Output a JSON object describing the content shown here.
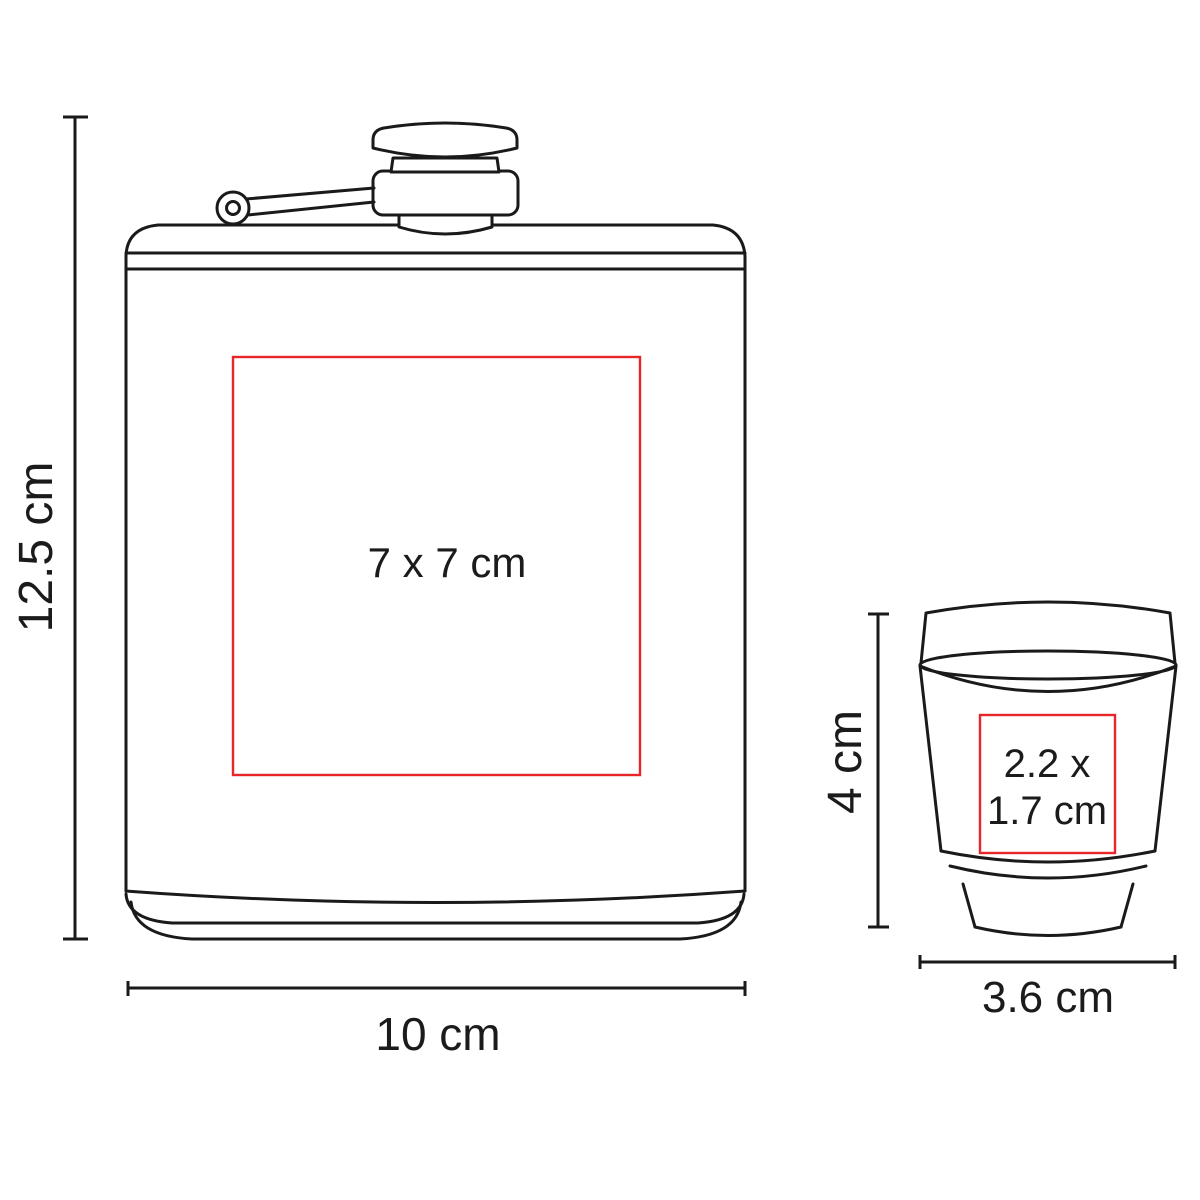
{
  "diagram": {
    "type": "product-dimension-diagram",
    "background": "#ffffff",
    "colors": {
      "line": "#1a1a1a",
      "print_area_red": "#e8262a",
      "text": "#1c1a1b"
    },
    "flask": {
      "name": "hip-flask",
      "height_label": "12.5 cm",
      "width_label": "10 cm",
      "print_area_label": "7 x 7 cm"
    },
    "cup": {
      "name": "shot-cup",
      "height_label": "4 cm",
      "width_label": "3.6 cm",
      "print_area_label_line1": "2.2 x",
      "print_area_label_line2": "1.7 cm"
    }
  }
}
